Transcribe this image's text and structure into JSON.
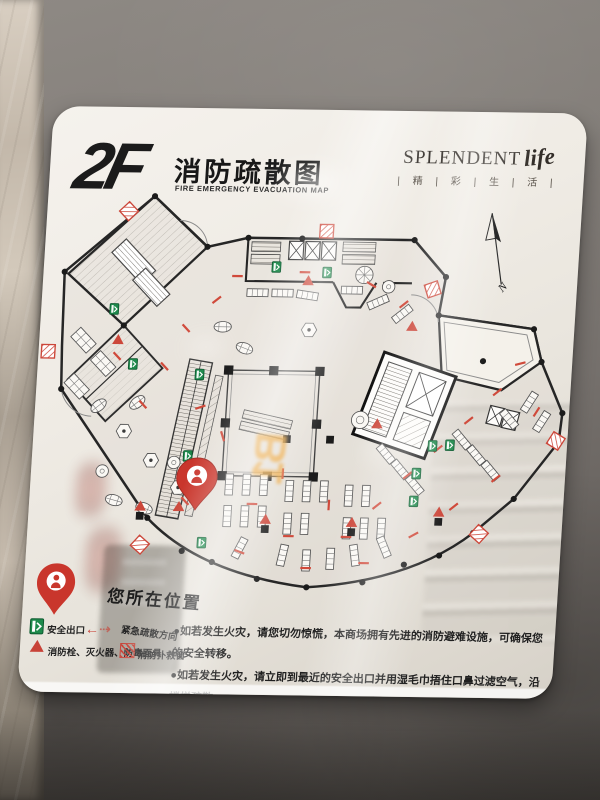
{
  "sign": {
    "floor": "2F",
    "title_zh": "消防疏散图",
    "title_en": "FIRE EMERGENCY EVACUATION MAP",
    "brand": {
      "name": "SPLENDENT",
      "script": "life",
      "tagline": "| 精 | 彩 | 生 | 活 |"
    },
    "compass_label": "N",
    "glare_text": "B1",
    "you_are_here": "您所在位置",
    "legend": {
      "exit": "安全出口",
      "direction": "紧急疏散方向",
      "equipment": "消防栓、灭火器、防毒面具",
      "rescue_window": "消防扑救窗"
    },
    "instructions": [
      "●如若发生火灾，请您切勿惊慌，本商场拥有先进的消防避难设施，可确保您的安全转移。",
      "●如若发生火灾，请立即到最近的安全出口并用湿毛巾捂住口鼻过滤空气，沿楼梯疏散。",
      "●如若发生火灾，切勿搭乘电梯。"
    ],
    "colors": {
      "accent_red": "#c84237",
      "exit_green": "#1e8a4c",
      "panel": "#efebe4",
      "line": "#262626"
    }
  }
}
